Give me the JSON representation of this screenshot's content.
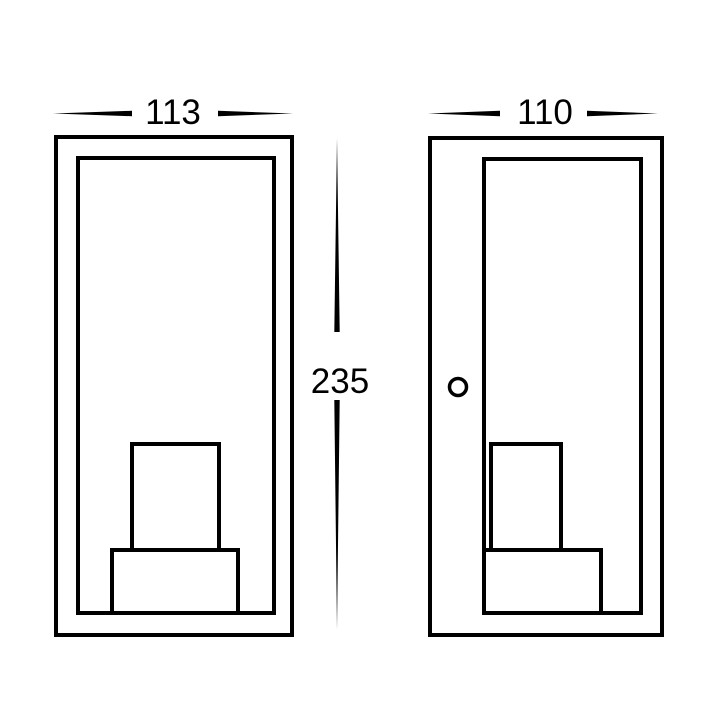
{
  "colors": {
    "line": "#000000",
    "background": "#ffffff"
  },
  "dimension_labels": {
    "width": "113",
    "depth": "110",
    "height": "235"
  }
}
